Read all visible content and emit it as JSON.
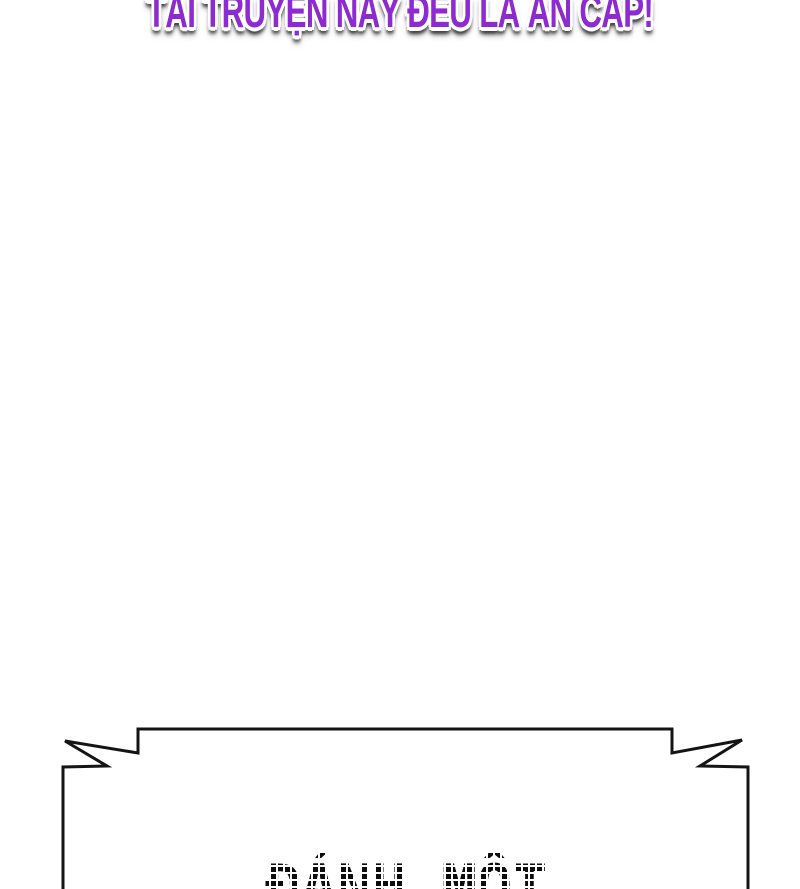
{
  "page": {
    "background_color": "#ffffff"
  },
  "watermark": {
    "text": "TẢI TRUYỆN NÀY ĐỀU LÀ ĂN CẮP!",
    "fill_color": "#8D2BD0",
    "outline_color": "#ffffff",
    "shadow_color": "#3d3d3d"
  },
  "banner": {
    "title_visible_text": "ĐÁNH MỘT",
    "title_color": "#0d0d0d",
    "fill_color": "#ffffff",
    "outline_color": "#141414"
  }
}
